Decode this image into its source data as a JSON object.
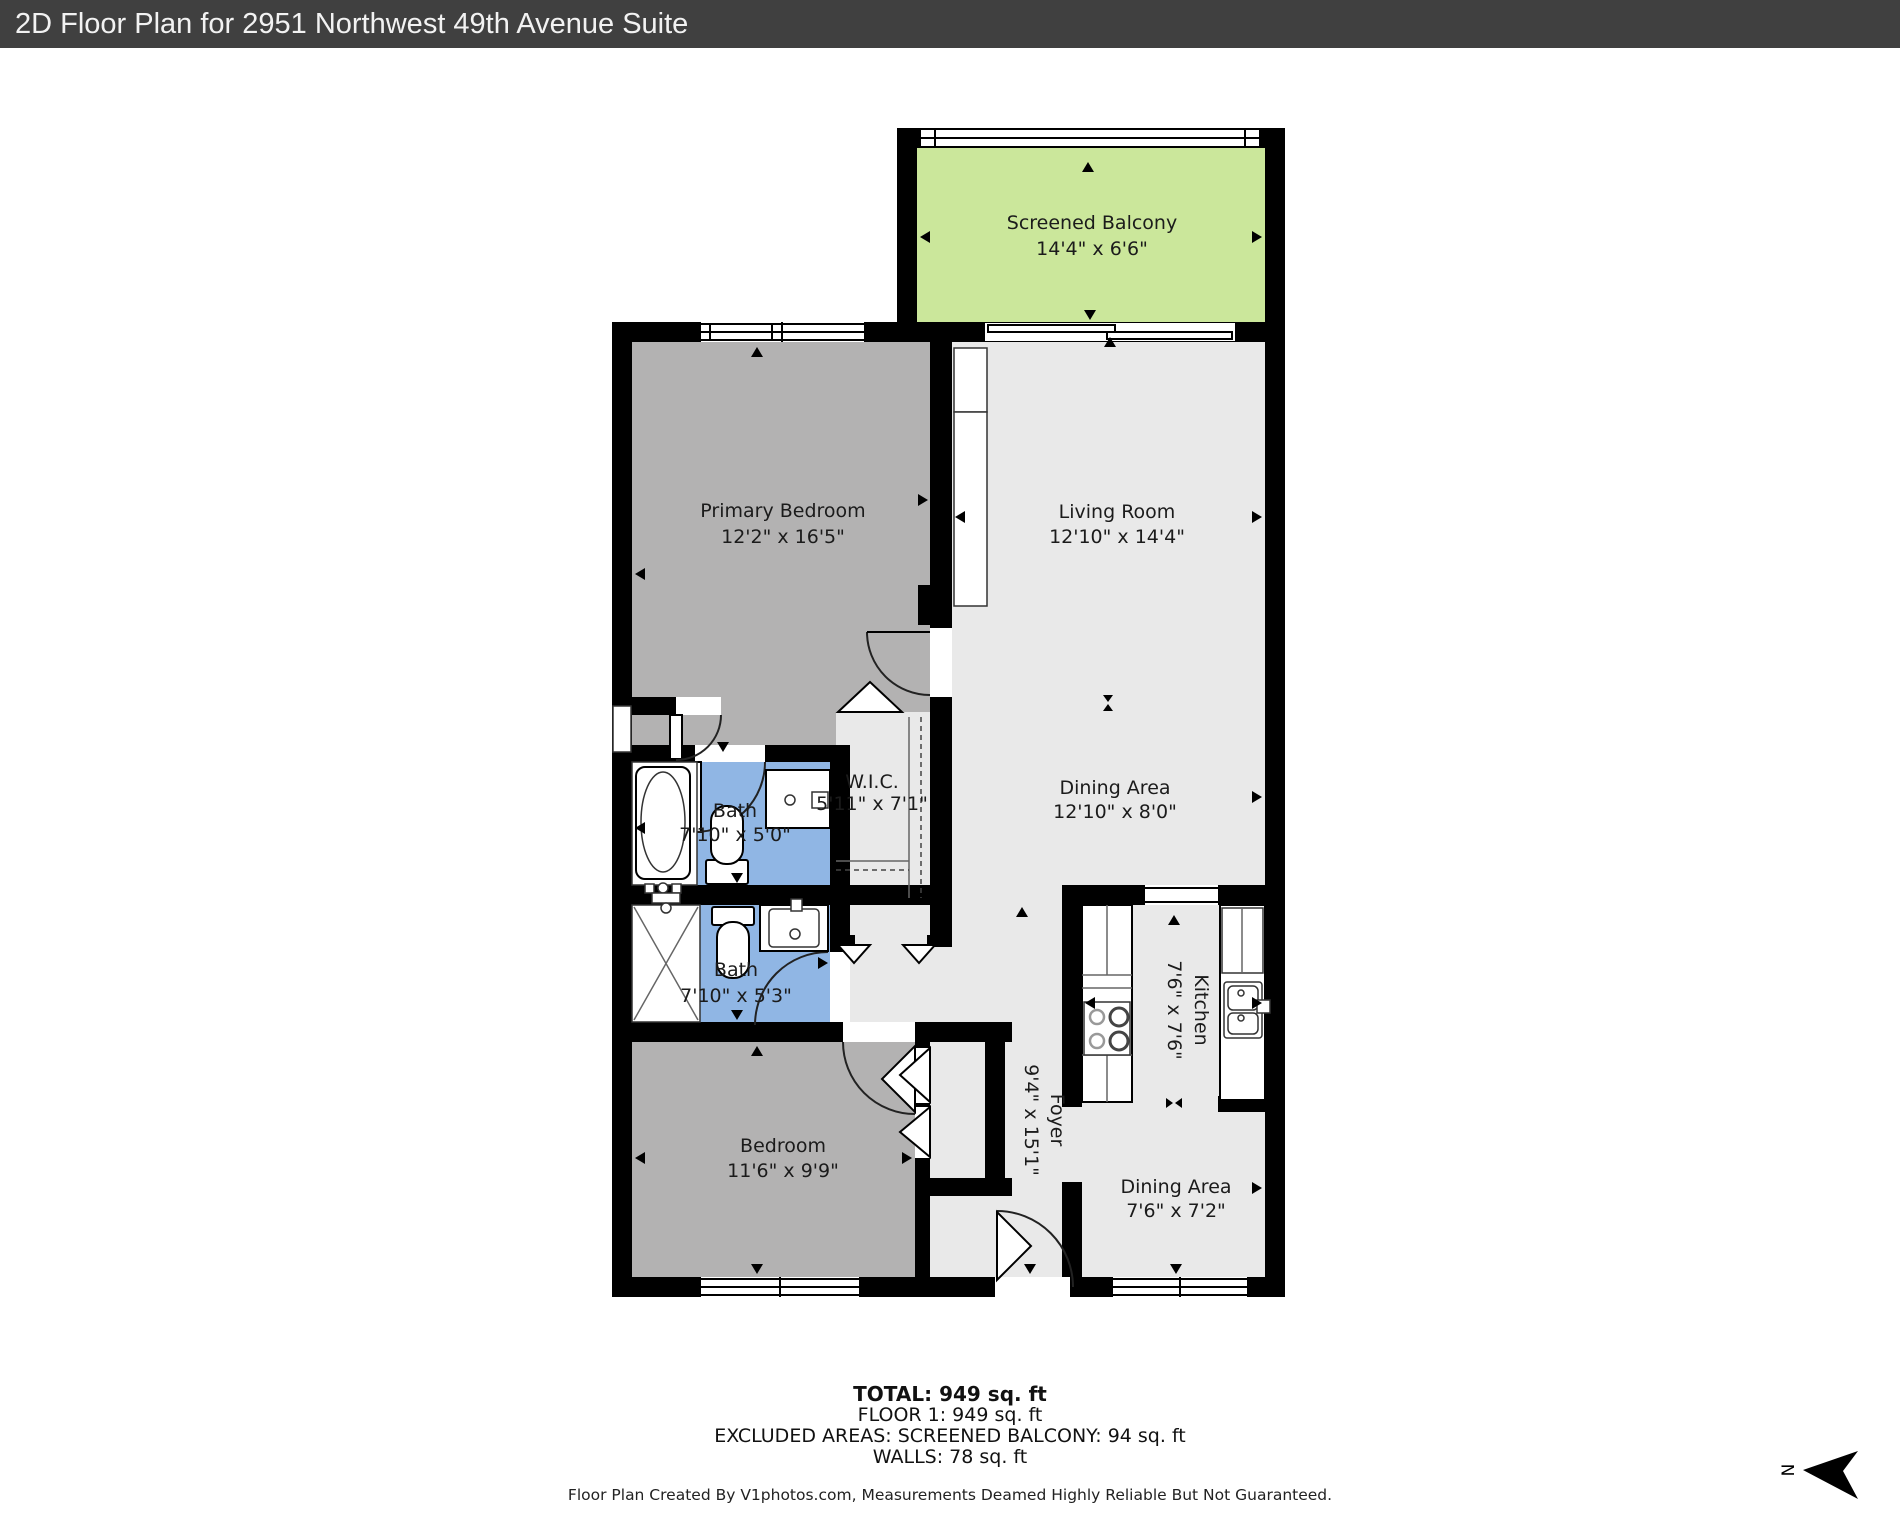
{
  "header": {
    "title": "2D Floor Plan for 2951 Northwest 49th Avenue Suite"
  },
  "plan": {
    "rooms": [
      {
        "id": "screened-balcony",
        "name": "Screened Balcony",
        "dims": "14'4\" x 6'6\""
      },
      {
        "id": "primary-bedroom",
        "name": "Primary Bedroom",
        "dims": "12'2\" x 16'5\""
      },
      {
        "id": "living-room",
        "name": "Living Room",
        "dims": "12'10\" x 14'4\""
      },
      {
        "id": "wic",
        "name": "W.I.C.",
        "dims": "5'11\" x 7'1\""
      },
      {
        "id": "bath-1",
        "name": "Bath",
        "dims": "7'10\" x 5'0\""
      },
      {
        "id": "dining-area",
        "name": "Dining Area",
        "dims": "12'10\" x 8'0\""
      },
      {
        "id": "bath-2",
        "name": "Bath",
        "dims": "7'10\" x 5'3\""
      },
      {
        "id": "kitchen",
        "name": "Kitchen",
        "dims": "7'6\" x 7'6\""
      },
      {
        "id": "foyer",
        "name": "Foyer",
        "dims": "9'4\" x 15'1\""
      },
      {
        "id": "bedroom",
        "name": "Bedroom",
        "dims": "11'6\" x 9'9\""
      },
      {
        "id": "dining-area-2",
        "name": "Dining Area",
        "dims": "7'6\" x 7'2\""
      }
    ],
    "compass": {
      "label": "N"
    },
    "colors": {
      "balcony": "#cbe79b",
      "bedroom_fill": "#b3b2b2",
      "open_area_fill": "#e9e9e9",
      "bath_fill": "#90b6e4",
      "wall": "#000000",
      "titlebar": "#404040"
    }
  },
  "summary": {
    "total": "TOTAL: 949 sq. ft",
    "floor": "FLOOR 1: 949 sq. ft",
    "excluded": "EXCLUDED AREAS: SCREENED BALCONY: 94 sq. ft",
    "walls": "WALLS: 78 sq. ft"
  },
  "footer": {
    "disclaimer": "Floor Plan Created By V1photos.com, Measurements Deamed Highly Reliable But Not Guaranteed."
  }
}
